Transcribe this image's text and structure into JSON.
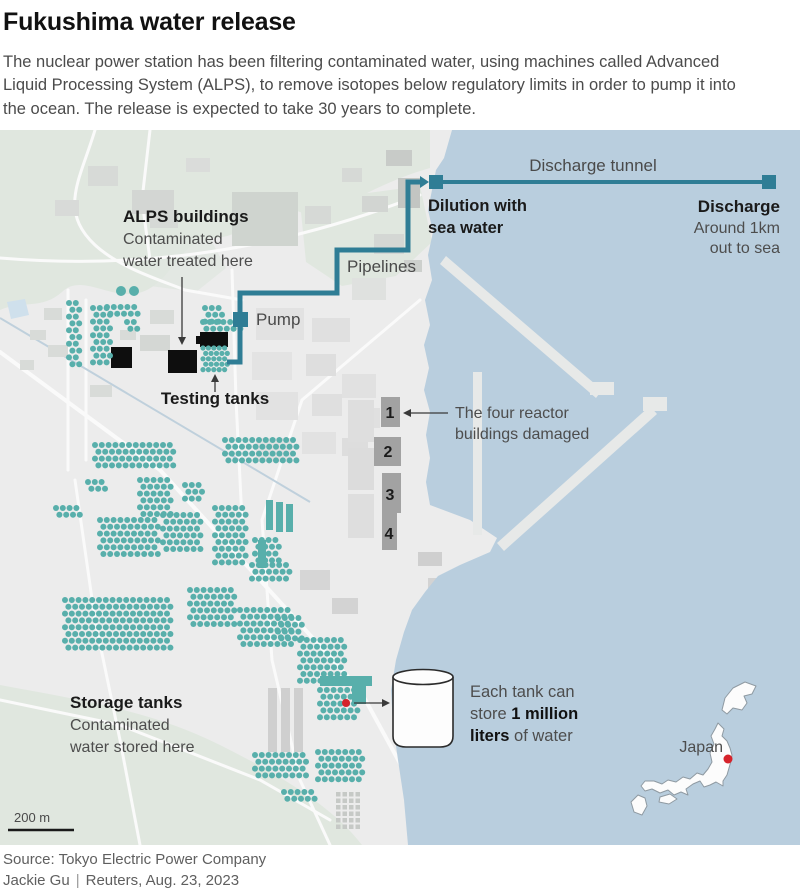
{
  "header": {
    "title": "Fukushima water release",
    "intro_line1": "The nuclear power station has been filtering contaminated water, using machines called Advanced",
    "intro_line2": "Liquid Processing System (ALPS), to remove isotopes below regulatory limits in order to pump it into",
    "intro_line3": "the ocean. The release is expected to take 30 years to complete."
  },
  "map": {
    "labels": {
      "alps": {
        "title": "ALPS buildings",
        "line1": "Contaminated",
        "line2": "water treated here"
      },
      "testing_tanks": "Testing tanks",
      "pump": "Pump",
      "pipelines": "Pipelines",
      "dilution": {
        "line1": "Dilution with",
        "line2": "sea water"
      },
      "discharge_tunnel": "Discharge tunnel",
      "discharge": {
        "title": "Discharge",
        "line1": "Around 1km",
        "line2": "out to sea"
      },
      "reactors": {
        "line1": "The four reactor",
        "line2": "buildings damaged",
        "numbers": [
          "1",
          "2",
          "3",
          "4"
        ]
      },
      "storage": {
        "title": "Storage tanks",
        "line1": "Contaminated",
        "line2": "water stored here"
      },
      "tank_note": {
        "line1": "Each tank can",
        "line2_pre": "store ",
        "line2_bold": "1 million",
        "line3_bold": "liters",
        "line3_post": " of water"
      },
      "japan": "Japan",
      "scale": "200 m"
    },
    "colors": {
      "ocean": "#b9cede",
      "land": "#ececec",
      "green": "#e0e7df",
      "tank_teal": "#58afab",
      "pipe_teal": "#2f7d95",
      "reactor_gray": "#a2a2a2",
      "alps_black": "#0e0e0e",
      "marker_red": "#d6232b"
    }
  },
  "footer": {
    "source": "Source: Tokyo Electric Power Company",
    "byline": "Jackie Gu",
    "separator": "|",
    "credit": "Reuters, Aug. 23, 2023"
  }
}
